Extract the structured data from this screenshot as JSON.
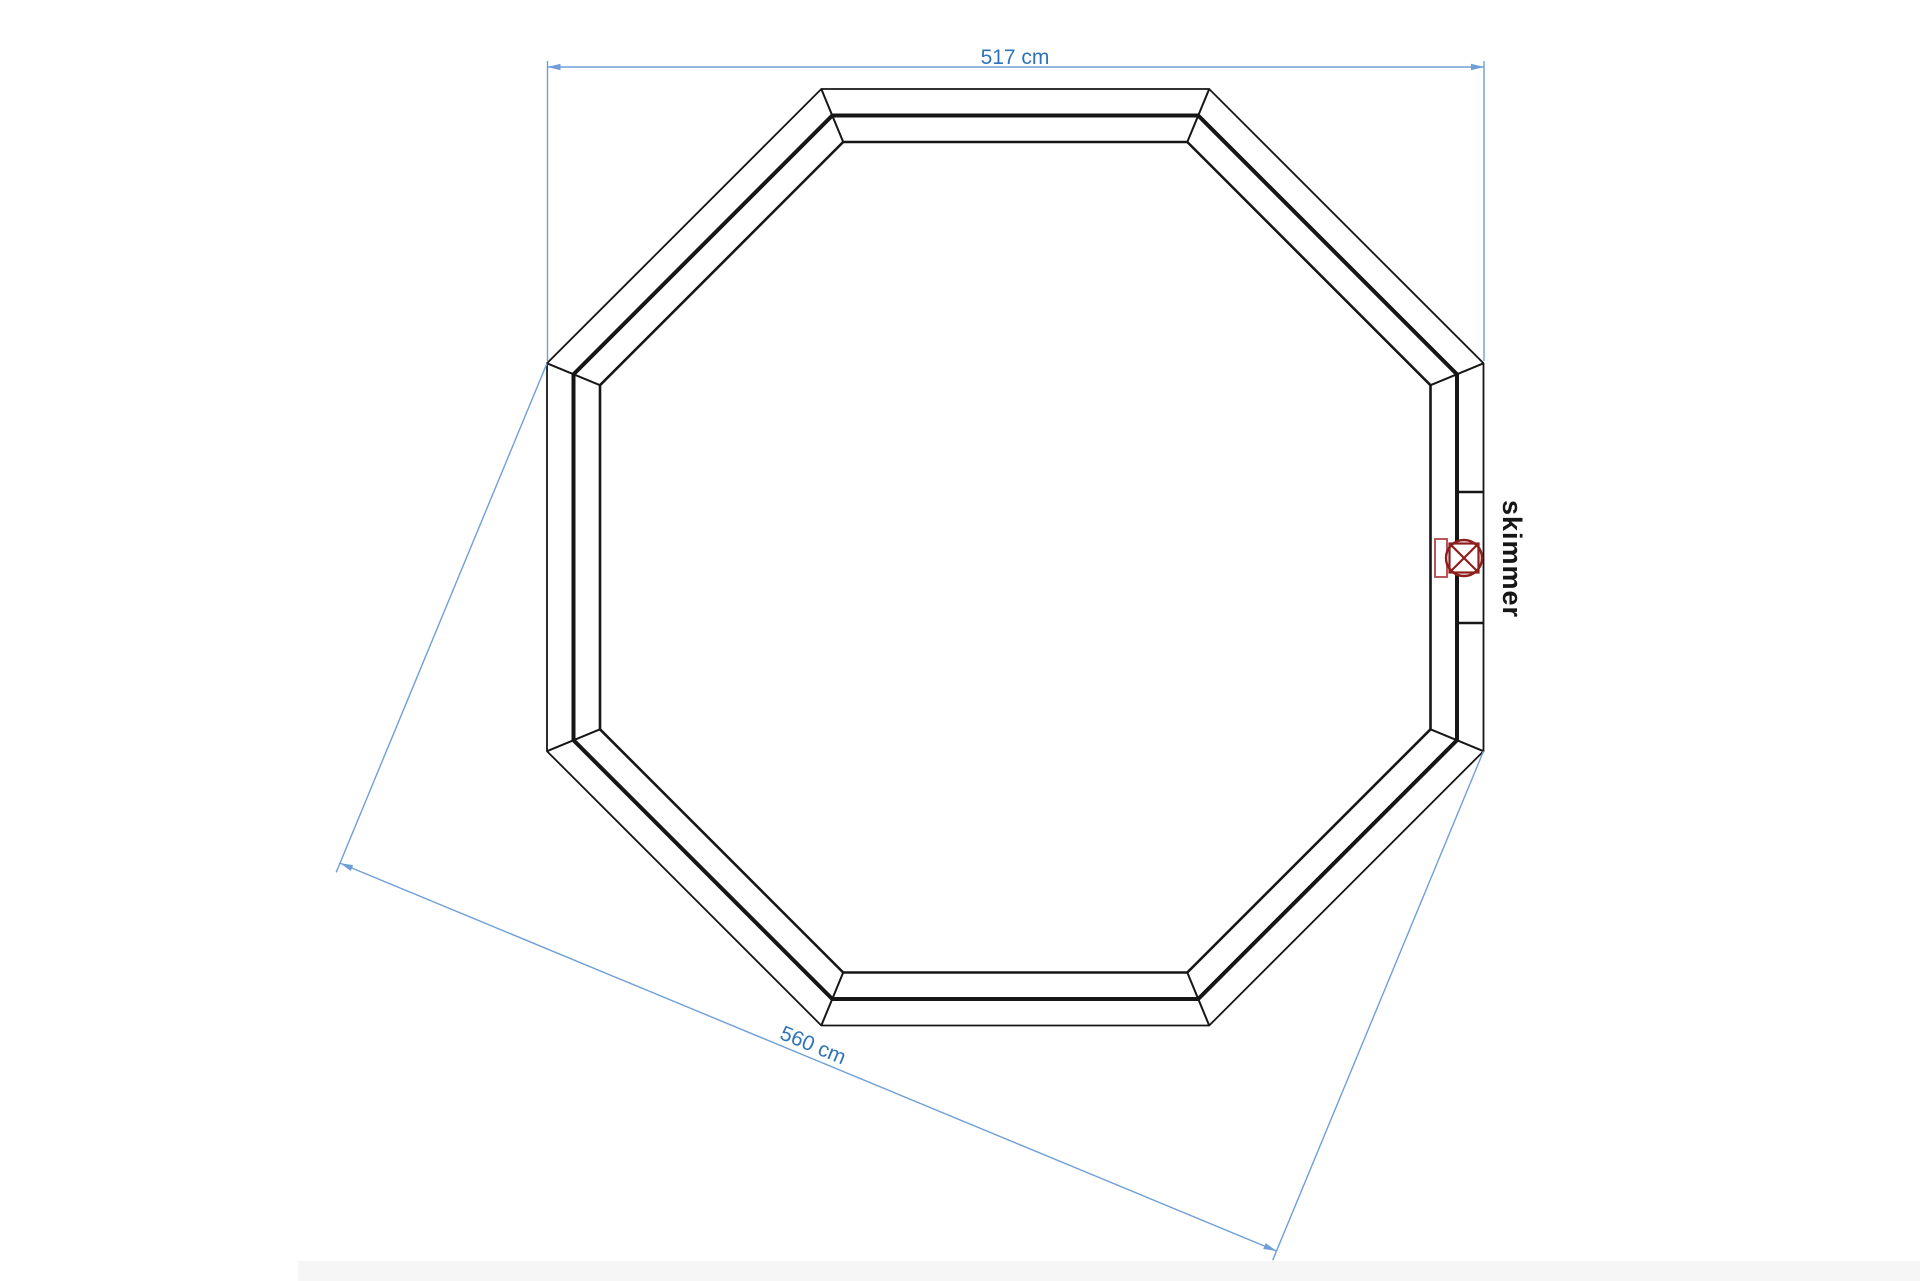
{
  "drawing": {
    "subject": "octagonal-pool-top-view",
    "dimensions": {
      "top_width": "517 cm",
      "diagonal_width": "560 cm"
    },
    "labels": {
      "skimmer": "skimmer"
    },
    "colors": {
      "background": "#ffffff",
      "wall_outline": "#161616",
      "dimension_line_blue": "#6f9fd8",
      "dimension_text_blue": "#2e74b8",
      "skimmer_dark_red": "#8e1f1f",
      "skimmer_light_red": "#b04545",
      "label_black": "#161616",
      "page_edge_gray": "#f6f6f6"
    }
  }
}
